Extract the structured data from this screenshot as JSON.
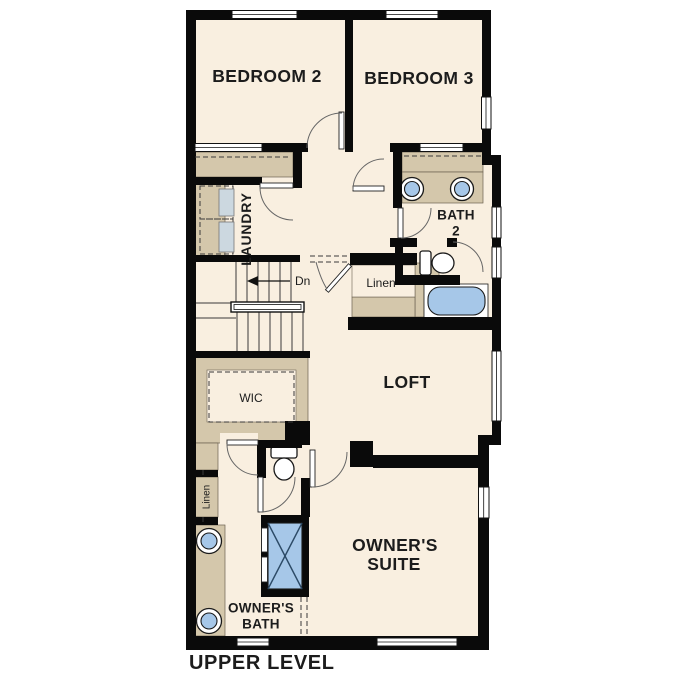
{
  "title": "UPPER LEVEL",
  "colors": {
    "wall": "#0a0a0a",
    "floor": "#f9efe0",
    "tan": "#d4c7ab",
    "blue": "#a6c7e8",
    "appliance": "#ccd8e0",
    "line": "#3a3a3a",
    "text": "#1c1c1c",
    "background": "#ffffff"
  },
  "rooms": {
    "bedroom2": {
      "label": "BEDROOM 2"
    },
    "bedroom3": {
      "label": "BEDROOM 3"
    },
    "laundry": {
      "label": "LAUNDRY"
    },
    "bath2": {
      "label_line1": "BATH",
      "label_line2": "2"
    },
    "linen_hall": {
      "label": "Linen"
    },
    "loft": {
      "label": "LOFT"
    },
    "wic": {
      "label": "WIC"
    },
    "linen_owners": {
      "label": "Linen"
    },
    "owners_suite": {
      "label_line1": "OWNER'S",
      "label_line2": "SUITE"
    },
    "owners_bath": {
      "label_line1": "OWNER'S",
      "label_line2": "BATH"
    }
  },
  "stairs": {
    "direction_label": "Dn"
  }
}
